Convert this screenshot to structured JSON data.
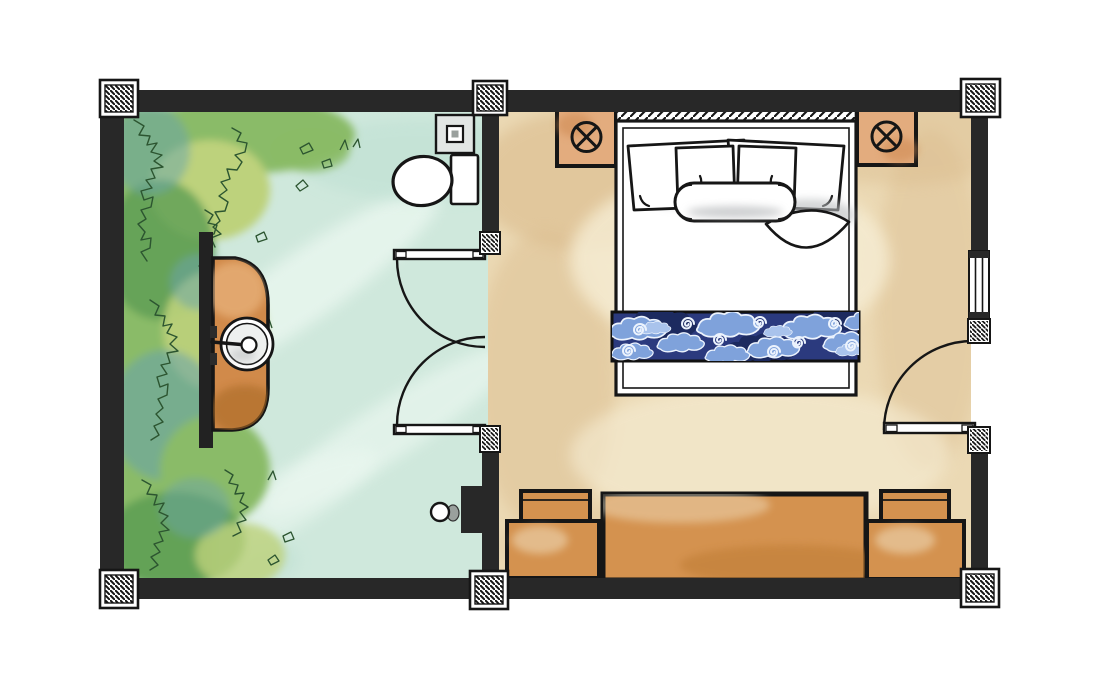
{
  "colors": {
    "wall": "#282828",
    "ink": "#161616",
    "paper": "#ffffff",
    "bathroom_floor": "#cfe8dc",
    "bathroom_floor_light": "#ecf8f1",
    "bedroom_floor": "#ebd9b4",
    "bedroom_floor_dark": "#d9b98a",
    "bedroom_floor_light": "#f6edd4",
    "bench_wood": "#d4924f",
    "bench_wood_dark": "#b9772f",
    "nightstand_wood": "#e3ac7e",
    "vanity_wood": "#d18a4a",
    "vanity_wood_dark": "#a96a28",
    "batik_navy": "#2b3a7e",
    "batik_navy_dark": "#1c2a5f",
    "batik_cloud": "#7fa2db",
    "batik_cloud_light": "#a9c3ec",
    "batik_line": "#ecf3fd",
    "foliage_green": "#8abb67",
    "foliage_yellow": "#bdd27b",
    "foliage_deep": "#5d9e55",
    "foliage_teal": "#68a3ae",
    "foliage_ink": "#2c5530",
    "fixture_gray": "#e2e6e4",
    "fixture_gray_dark": "#9aa09d",
    "pillow_shade": "#b9bcbe"
  },
  "elements": {
    "rooms": [
      "bathroom",
      "bedroom"
    ],
    "structure": [
      "perimeter-wall",
      "partition-wall",
      "column-hatched",
      "door-jamb-hatched"
    ],
    "openings": [
      "window",
      "entry-door-swing",
      "bathroom-double-door-swing"
    ],
    "bathroom_fixtures": [
      "planting-bed",
      "vanity-counter",
      "round-sink",
      "faucet",
      "tap-handles",
      "toilet-bowl",
      "toilet-tank",
      "flush-plate",
      "wall-shower-fixture"
    ],
    "bedroom_fixtures": [
      "headboard",
      "double-bed",
      "pillow",
      "pillow",
      "pillow",
      "pillow",
      "bolster-pillow",
      "batik-bed-runner",
      "folded-sheet-corner",
      "bedside-table-left",
      "bedside-table-right",
      "lamp-symbol",
      "lamp-symbol",
      "bench",
      "side-table-left",
      "side-table-right"
    ]
  }
}
